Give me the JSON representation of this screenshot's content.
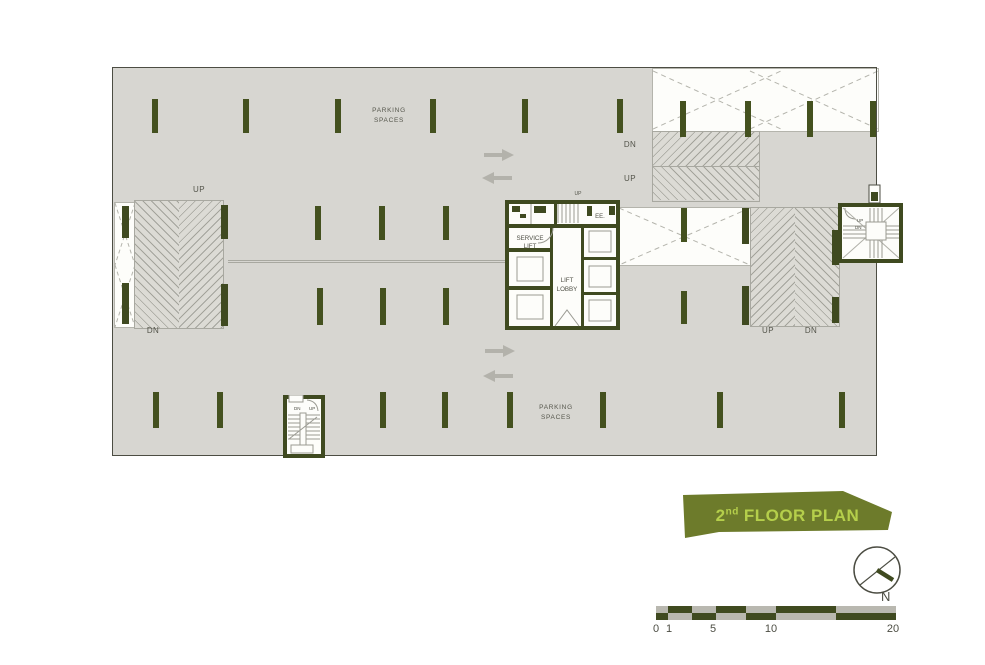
{
  "colors": {
    "wall_green": "#3f4a20",
    "floor_gray": "#d7d6d1",
    "hatch_line": "#a3a39b",
    "banner_green": "#6d7b2b",
    "banner_text_green": "#b5cf4b",
    "label_gray": "#53544a",
    "arrow_gray": "#b3b2ab"
  },
  "plan": {
    "parking_top": {
      "line1": "PARKING",
      "line2": "SPACES"
    },
    "parking_bottom": {
      "line1": "PARKING",
      "line2": "SPACES"
    },
    "left_ramp": {
      "up": "UP",
      "dn": "DN"
    },
    "top_right_ramp": {
      "dn": "DN",
      "up": "UP"
    },
    "right_ramp": {
      "up": "UP",
      "dn": "DN"
    },
    "core": {
      "up": "UP",
      "ee": "EE.",
      "service_line1": "SERVICE",
      "service_line2": "LIFT",
      "lobby_line1": "LIFT",
      "lobby_line2": "LOBBY"
    },
    "bottom_stair": {
      "dn": "DN",
      "up": "UP"
    },
    "right_stair": {
      "up": "UP",
      "dn": "DN"
    }
  },
  "title_banner": {
    "number": "2",
    "ordinal": "nd",
    "text": "FLOOR PLAN"
  },
  "compass": {
    "label": "N"
  },
  "scale_bar": {
    "ticks": [
      "0",
      "1",
      "5",
      "10",
      "20"
    ]
  }
}
